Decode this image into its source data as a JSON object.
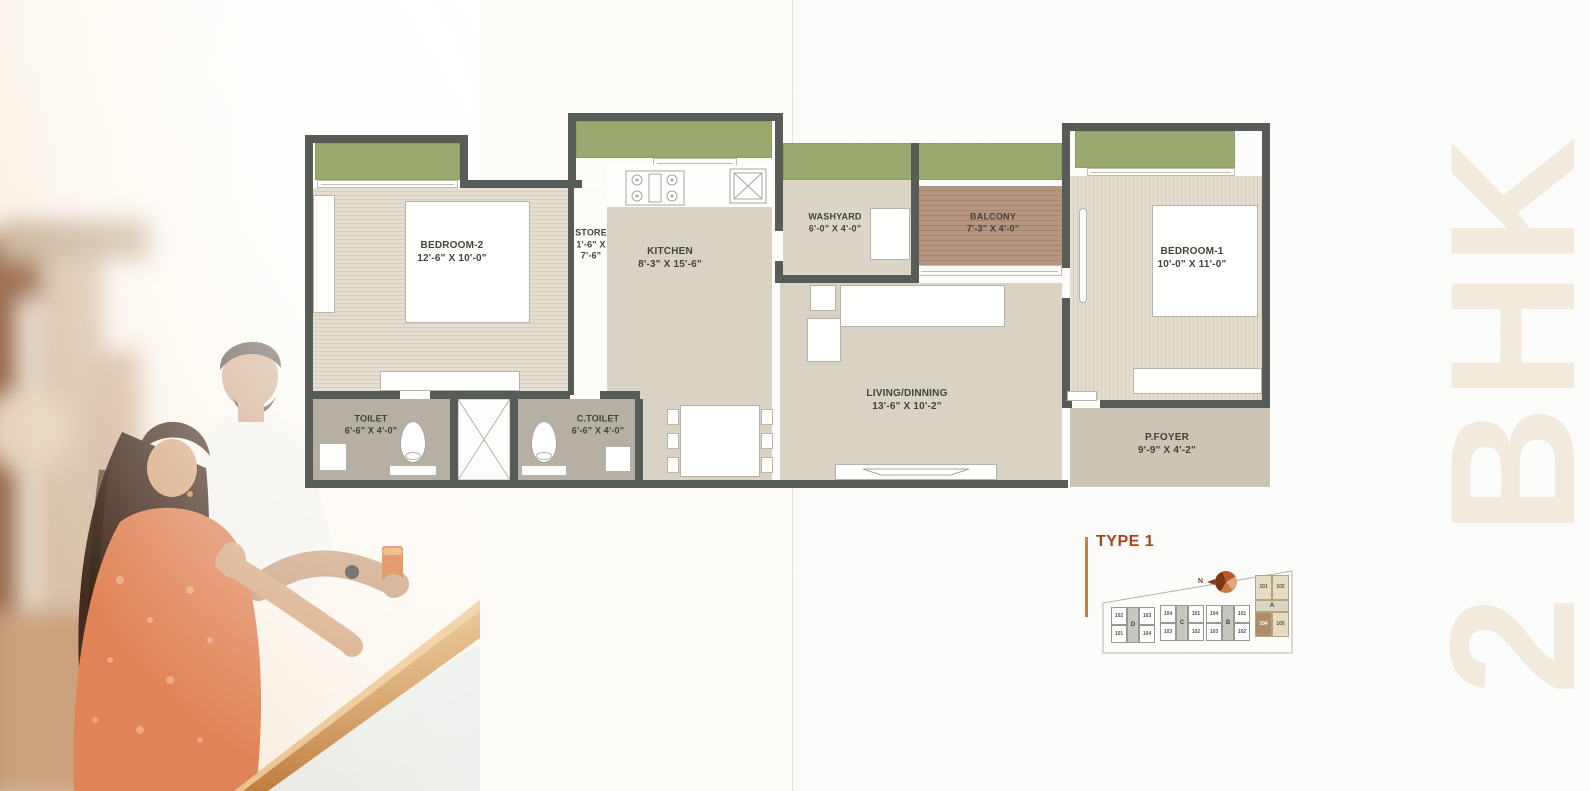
{
  "side_label": "2 BHK",
  "plan": {
    "rooms": [
      {
        "name": "BEDROOM-2",
        "dims": "12'-6\" X 10'-0\""
      },
      {
        "name": "STORE",
        "dims_line1": "1'-6\" X",
        "dims_line2": "7'-6\""
      },
      {
        "name": "KITCHEN",
        "dims": "8'-3\" X 15'-6\""
      },
      {
        "name": "WASHYARD",
        "dims": "6'-0\" X 4'-0\""
      },
      {
        "name": "BALCONY",
        "dims": "7'-3\" X 4'-0\""
      },
      {
        "name": "BEDROOM-1",
        "dims": "10'-0\" X 11'-0\""
      },
      {
        "name": "LIVING/DINNING",
        "dims": "13'-6\" X 10'-2\""
      },
      {
        "name": "TOILET",
        "dims": "6'-6\" X 4'-0\""
      },
      {
        "name": "C.TOILET",
        "dims": "6'-6\" X 4'-0\""
      },
      {
        "name": "P.FOYER",
        "dims": "9'-9\" X 4'-2\""
      }
    ]
  },
  "keyplan": {
    "title": "TYPE 1",
    "north_label": "N",
    "blocks": [
      {
        "label": "D",
        "col1": [
          "102",
          "101"
        ],
        "col2": [
          "103",
          "104"
        ]
      },
      {
        "label": "C",
        "col1": [
          "104",
          "103"
        ],
        "col2": [
          "101",
          "102"
        ]
      },
      {
        "label": "B",
        "col1": [
          "104",
          "103"
        ],
        "col2": [
          "101",
          "102"
        ]
      },
      {
        "label": "A",
        "row1": [
          "101",
          "102"
        ],
        "row2": [
          "104",
          "105"
        ],
        "highlighted_unit": "104"
      }
    ]
  },
  "colors": {
    "wall": "#575C57",
    "window_green": "#9AA96F",
    "floor": "#D9D3C6",
    "bedroom_floor": "#E0D9CC",
    "toilet_floor": "#B5B0A3",
    "balcony_floor": "#B2917A",
    "foyer_floor": "#CCC5B6",
    "accent_rust": "#A8431F",
    "accent_orange_line": "#CD7F42",
    "side_text": "#F3EADE"
  }
}
